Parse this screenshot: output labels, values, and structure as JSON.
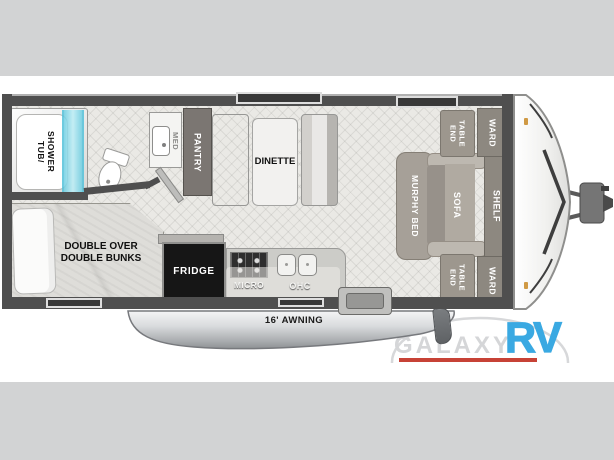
{
  "page": {
    "background_color": "#d2d3d4",
    "canvas_color": "#ffffff"
  },
  "floorplan": {
    "labels": {
      "tub_shower": [
        "TUB/",
        "SHOWER"
      ],
      "med": "MED",
      "pantry": "PANTRY",
      "dinette": "DINETTE",
      "end_table": [
        "END",
        "TABLE"
      ],
      "ward": "WARD",
      "murphy_bed": "MURPHY BED",
      "sofa": "SOFA",
      "shelf": "SHELF",
      "bunks": [
        "DOUBLE OVER",
        "DOUBLE BUNKS"
      ],
      "fridge": "FRIDGE",
      "micro": "MICRO",
      "ohc": "OHC",
      "awning": "16' AWNING"
    },
    "colors": {
      "wall": "#4f4f4f",
      "floor": "#eae9e5",
      "tub_glass_blue": "#7fd4e6",
      "fridge_black": "#161616",
      "furniture_taupe": "#a6a098"
    }
  },
  "logo": {
    "brand": "GALAXY",
    "suffix": "RV",
    "brand_color": "#d5d6d8",
    "suffix_color": "#3aa9e2",
    "underline_color": "#c74236"
  }
}
